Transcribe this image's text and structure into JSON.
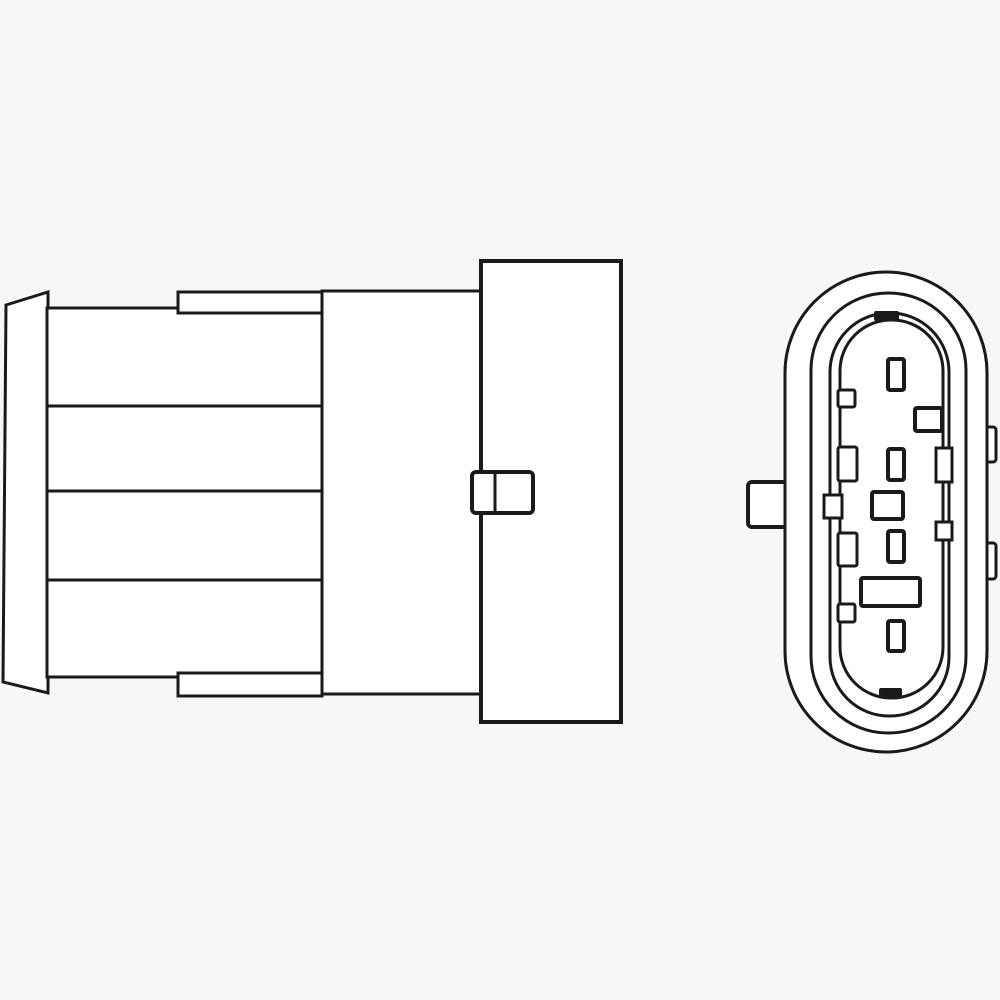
{
  "drawing": {
    "kind": "technical-line-drawing",
    "subject": "oxygen-sensor-connector",
    "views": {
      "left": "connector-side-view",
      "right": "connector-end-view"
    },
    "colors": {
      "background": "#f7f7f7",
      "ink": "#1a1a1a",
      "shape_fill": "#ffffff"
    },
    "canvas": {
      "width": 1000,
      "height": 1000
    },
    "shapes": [
      {
        "type": "polygon",
        "name": "flange-cap",
        "points": [
          [
            6,
            305
          ],
          [
            48,
            292
          ],
          [
            48,
            693
          ],
          [
            3,
            682
          ]
        ],
        "sw": 3
      },
      {
        "type": "rect",
        "name": "ribbed-body",
        "x": 47,
        "y": 308,
        "w": 275,
        "h": 369,
        "sw": 3
      },
      {
        "type": "line",
        "name": "rib-line-1",
        "x1": 47,
        "y1": 406,
        "x2": 322,
        "y2": 406,
        "sw": 3
      },
      {
        "type": "line",
        "name": "rib-line-2",
        "x1": 47,
        "y1": 491,
        "x2": 322,
        "y2": 491,
        "sw": 3
      },
      {
        "type": "line",
        "name": "rib-line-3",
        "x1": 47,
        "y1": 580,
        "x2": 322,
        "y2": 580,
        "sw": 3
      },
      {
        "type": "rect",
        "name": "top-tab",
        "x": 178,
        "y": 292,
        "w": 144,
        "h": 21,
        "sw": 3
      },
      {
        "type": "rect",
        "name": "bottom-tab",
        "x": 178,
        "y": 673,
        "w": 144,
        "h": 23,
        "sw": 3
      },
      {
        "type": "rect",
        "name": "connector-neck",
        "x": 322,
        "y": 291,
        "w": 159,
        "h": 403,
        "sw": 3
      },
      {
        "type": "rect",
        "name": "connector-housing",
        "x": 481,
        "y": 261,
        "w": 140,
        "h": 461,
        "sw": 4
      },
      {
        "type": "rect",
        "name": "latch-clip",
        "x": 472,
        "y": 472,
        "w": 61,
        "h": 41,
        "rx": 4,
        "sw": 4
      },
      {
        "type": "line",
        "name": "latch-divider",
        "x1": 495,
        "y1": 472,
        "x2": 495,
        "y2": 513,
        "sw": 3
      },
      {
        "type": "rect",
        "name": "mount-tab",
        "x": 748,
        "y": 482,
        "w": 42,
        "h": 45,
        "rx": 4,
        "sw": 4
      },
      {
        "type": "rect",
        "name": "side-lug-top",
        "x": 980,
        "y": 427,
        "w": 16,
        "h": 35,
        "rx": 3,
        "sw": 3
      },
      {
        "type": "rect",
        "name": "side-lug-bottom",
        "x": 980,
        "y": 543,
        "w": 16,
        "h": 36,
        "rx": 3,
        "sw": 3
      },
      {
        "type": "rect",
        "name": "outer-shell",
        "x": 785,
        "y": 272,
        "w": 202,
        "h": 480,
        "rx": 101,
        "sw": 3
      },
      {
        "type": "rect",
        "name": "seal-ring",
        "x": 811,
        "y": 293,
        "w": 155,
        "h": 440,
        "rx": 77,
        "sw": 3
      },
      {
        "type": "rect",
        "name": "terminal-tower",
        "x": 830,
        "y": 313,
        "w": 119,
        "h": 403,
        "rx": 59,
        "sw": 3
      },
      {
        "type": "rect",
        "name": "tower-cavity",
        "x": 840,
        "y": 320,
        "w": 103,
        "h": 378,
        "rx": 51,
        "sw": 3
      },
      {
        "type": "rect",
        "name": "key-jog-left",
        "x": 824,
        "y": 495,
        "w": 18,
        "h": 23,
        "sw": 3
      },
      {
        "type": "rect",
        "name": "key-jog-right-top",
        "x": 936,
        "y": 448,
        "w": 16,
        "h": 34,
        "sw": 3
      },
      {
        "type": "rect",
        "name": "key-jog-right-bottom",
        "x": 936,
        "y": 522,
        "w": 16,
        "h": 18,
        "sw": 3
      },
      {
        "type": "rect",
        "name": "key-bump-1",
        "x": 838,
        "y": 390,
        "w": 17,
        "h": 17,
        "rx": 2,
        "sw": 3
      },
      {
        "type": "rect",
        "name": "key-bump-2",
        "x": 838,
        "y": 447,
        "w": 19,
        "h": 34,
        "rx": 2,
        "sw": 3
      },
      {
        "type": "rect",
        "name": "key-bump-3",
        "x": 838,
        "y": 533,
        "w": 19,
        "h": 33,
        "rx": 2,
        "sw": 3
      },
      {
        "type": "rect",
        "name": "key-bump-4",
        "x": 838,
        "y": 604,
        "w": 17,
        "h": 18,
        "rx": 2,
        "sw": 3
      },
      {
        "type": "rect",
        "name": "pin-slot-1",
        "x": 888,
        "y": 359,
        "w": 16,
        "h": 31,
        "rx": 2,
        "sw": 4
      },
      {
        "type": "rect",
        "name": "pin-slot-2",
        "x": 915,
        "y": 408,
        "w": 27,
        "h": 23,
        "rx": 2,
        "sw": 4
      },
      {
        "type": "rect",
        "name": "pin-slot-3",
        "x": 888,
        "y": 449,
        "w": 16,
        "h": 31,
        "rx": 2,
        "sw": 4
      },
      {
        "type": "rect",
        "name": "pin-slot-4",
        "x": 872,
        "y": 492,
        "w": 31,
        "h": 27,
        "rx": 2,
        "sw": 4
      },
      {
        "type": "rect",
        "name": "pin-slot-5",
        "x": 888,
        "y": 531,
        "w": 16,
        "h": 31,
        "rx": 2,
        "sw": 4
      },
      {
        "type": "rect",
        "name": "pin-slot-6",
        "x": 861,
        "y": 578,
        "w": 59,
        "h": 28,
        "rx": 2,
        "sw": 4
      },
      {
        "type": "rect",
        "name": "pin-slot-7",
        "x": 888,
        "y": 621,
        "w": 16,
        "h": 30,
        "rx": 2,
        "sw": 4
      },
      {
        "type": "rect",
        "name": "index-mark-top",
        "x": 874,
        "y": 311,
        "w": 25,
        "h": 10,
        "rx": 2,
        "fill": "ink"
      },
      {
        "type": "rect",
        "name": "index-mark-bottom",
        "x": 879,
        "y": 688,
        "w": 23,
        "h": 10,
        "rx": 2,
        "fill": "ink"
      }
    ]
  }
}
